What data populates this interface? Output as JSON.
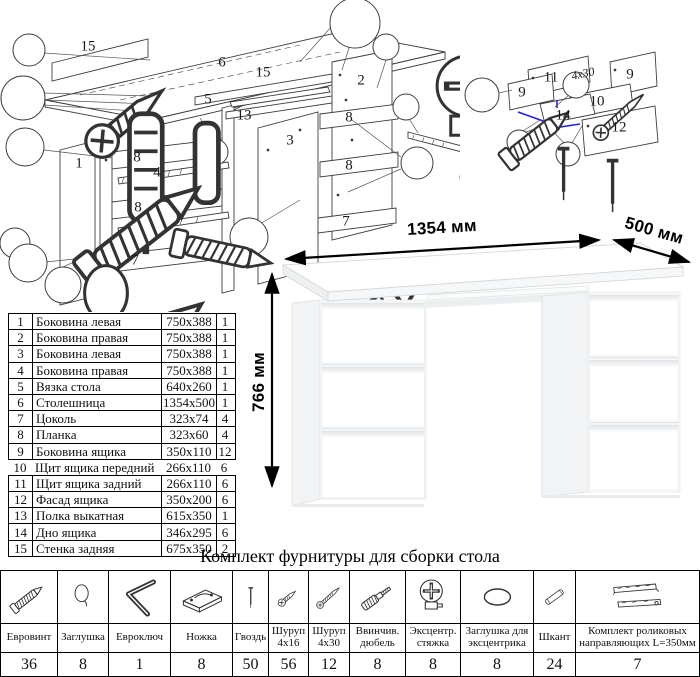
{
  "colors": {
    "accent_blue": "#2323e6",
    "diagram_line": "#3d3d3d",
    "table_border": "#000000"
  },
  "diagrams": {
    "main": {
      "labels": [
        {
          "text": "15",
          "x": 88,
          "y": 47
        },
        {
          "text": "6",
          "x": 222,
          "y": 63
        },
        {
          "text": "15",
          "x": 263,
          "y": 73
        },
        {
          "text": "5",
          "x": 208,
          "y": 100
        },
        {
          "text": "13",
          "x": 244,
          "y": 116
        },
        {
          "text": "2",
          "x": 361,
          "y": 81
        },
        {
          "text": "3",
          "x": 290,
          "y": 141
        },
        {
          "text": "1",
          "x": 79,
          "y": 164
        },
        {
          "text": "8",
          "x": 137,
          "y": 158
        },
        {
          "text": "4",
          "x": 157,
          "y": 173
        },
        {
          "text": "8",
          "x": 138,
          "y": 208
        },
        {
          "text": "7",
          "x": 135,
          "y": 261
        },
        {
          "text": "8",
          "x": 349,
          "y": 118
        },
        {
          "text": "8",
          "x": 349,
          "y": 166
        },
        {
          "text": "7",
          "x": 346,
          "y": 222
        }
      ]
    },
    "drawer": {
      "labels": [
        {
          "text": "11",
          "x": 111,
          "y": 48
        },
        {
          "text": "9",
          "x": 82,
          "y": 63
        },
        {
          "text": "9",
          "x": 190,
          "y": 45
        },
        {
          "text": "10",
          "x": 157,
          "y": 72
        },
        {
          "text": "14",
          "x": 123,
          "y": 86
        },
        {
          "text": "12",
          "x": 179,
          "y": 98
        },
        {
          "text": "4x30",
          "x": 143,
          "y": 44,
          "small": true
        }
      ]
    }
  },
  "parts_table": {
    "rows": [
      {
        "num": "1",
        "name": "Боковина левая",
        "size": "750x388",
        "qty": "1"
      },
      {
        "num": "2",
        "name": "Боковина правая",
        "size": "750x388",
        "qty": "1"
      },
      {
        "num": "3",
        "name": "Боковина левая",
        "size": "750x388",
        "qty": "1"
      },
      {
        "num": "4",
        "name": "Боковина правая",
        "size": "750x388",
        "qty": "1"
      },
      {
        "num": "5",
        "name": "Вязка стола",
        "size": "640x260",
        "qty": "1"
      },
      {
        "num": "6",
        "name": "Столешница",
        "size": "1354x500",
        "qty": "1"
      },
      {
        "num": "7",
        "name": "Цоколь",
        "size": "323x74",
        "qty": "4"
      },
      {
        "num": "8",
        "name": "Планка",
        "size": "323x60",
        "qty": "4"
      },
      {
        "num": "9",
        "name": "Боковина ящика",
        "size": "350x110",
        "qty": "12"
      },
      {
        "num": "10",
        "name": "Щит ящика передний",
        "size": "266x110",
        "qty": "6"
      },
      {
        "num": "11",
        "name": "Щит ящика задний",
        "size": "266x110",
        "qty": "6"
      },
      {
        "num": "12",
        "name": "Фасад ящика",
        "size": "350x200",
        "qty": "6"
      },
      {
        "num": "13",
        "name": "Полка выкатная",
        "size": "615x350",
        "qty": "1"
      },
      {
        "num": "14",
        "name": "Дно ящика",
        "size": "346x295",
        "qty": "6"
      },
      {
        "num": "15",
        "name": "Стенка задняя",
        "size": "675x350",
        "qty": "2"
      }
    ]
  },
  "desk": {
    "dim_width": "1354 мм",
    "dim_depth": "500 мм",
    "dim_height": "766 мм"
  },
  "hardware": {
    "title": "Комплект фурнитуры для сборки стола",
    "items": [
      {
        "name": "Евровинт",
        "qty": "36",
        "icon": "confirmat-screw-icon"
      },
      {
        "name": "Заглушка",
        "qty": "8",
        "icon": "cap-icon"
      },
      {
        "name": "Евроключ",
        "qty": "1",
        "icon": "hex-key-icon"
      },
      {
        "name": "Ножка",
        "qty": "8",
        "icon": "foot-glide-icon"
      },
      {
        "name": "Гвоздь",
        "qty": "50",
        "icon": "nail-icon"
      },
      {
        "name": "Шуруп 4x16",
        "qty": "56",
        "icon": "screw-small-icon"
      },
      {
        "name": "Шуруп 4x30",
        "qty": "12",
        "icon": "screw-long-icon"
      },
      {
        "name": "Ввинчив. дюбель",
        "qty": "8",
        "icon": "screw-in-dowel-icon"
      },
      {
        "name": "Эксцентр. стяжка",
        "qty": "8",
        "icon": "cam-lock-icon"
      },
      {
        "name": "Заглушка для эксцентрика",
        "qty": "8",
        "icon": "cam-cap-icon"
      },
      {
        "name": "Шкант",
        "qty": "24",
        "icon": "wood-dowel-icon"
      },
      {
        "name": "Комплект роликовых направляющих L=350мм",
        "qty": "7",
        "icon": "roller-slides-icon"
      }
    ]
  }
}
